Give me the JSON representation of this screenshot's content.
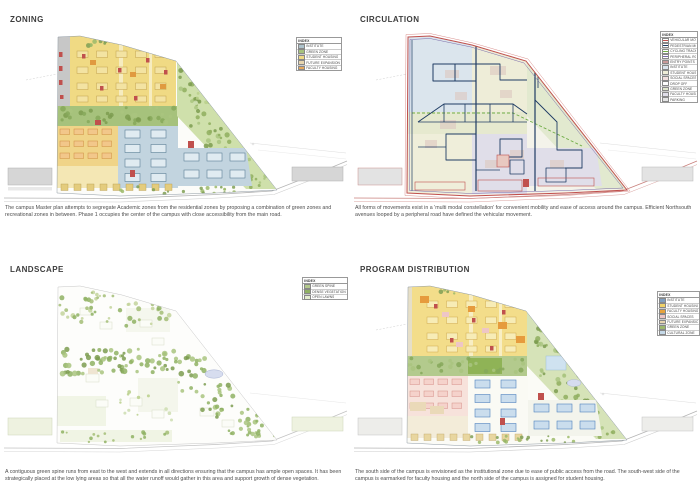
{
  "sheet": {
    "background": "#ffffff"
  },
  "colors": {
    "accent_red": "#c0504d",
    "navy": "#1f3c64",
    "peripheral_purple": "#7a6aa8",
    "green_dashed": "#70ad47"
  },
  "panels": [
    {
      "id": "zoning",
      "title": "ZONING",
      "caption": "The campus Master plan attempts to segregate Academic zones from the residential zones by proposing a combination of green zones and recreational zones in between. Phase 1 occupies the center of the campus with close accessibility from the main road.",
      "legend_title": "INDEX",
      "legend": [
        {
          "label": "INSTITUTE",
          "color": "#aec3cc"
        },
        {
          "label": "GREEN ZONE",
          "color": "#a6c27c"
        },
        {
          "label": "STUDENT HOUSING",
          "color": "#f0da84"
        },
        {
          "label": "FUTURE EXPANSION",
          "color": "#e7d5ae"
        },
        {
          "label": "FACULTY HOUSING",
          "color": "#e8a95c"
        }
      ]
    },
    {
      "id": "circulation",
      "title": "CIRCULATION",
      "caption": "All forms of movements exist in a 'multi modal constellation' for convenient mobility and ease of access around the campus. Efficient Northsouth avenues looped by a peripheral road have defined the vehicular movement.",
      "legend_title": "INDEX",
      "legend": [
        {
          "label": "VEHICULAR MOVEMENT",
          "color": "#c0504d",
          "type": "line"
        },
        {
          "label": "PEDESTRIAN MOVEMENT",
          "color": "#1f3c64",
          "type": "line"
        },
        {
          "label": "CYCLING TRACK",
          "color": "#70ad47",
          "type": "line"
        },
        {
          "label": "PERIPHERAL ROAD",
          "color": "#7a6aa8",
          "type": "line"
        },
        {
          "label": "ENTRY POINTS",
          "color": "#943634",
          "type": "line"
        },
        {
          "label": "INSTITUTE",
          "color": "#dbe5ed"
        },
        {
          "label": "STUDENT HOUSING",
          "color": "#eeedd8"
        },
        {
          "label": "SOCIAL SPACES",
          "color": "#f0dede"
        },
        {
          "label": "DROP OFF",
          "color": "#ffffff"
        },
        {
          "label": "GREEN ZONE",
          "color": "#e2e9cf"
        },
        {
          "label": "FACULTY HOUSING",
          "color": "#e0dee9"
        },
        {
          "label": "PARKING",
          "color": "#e4e4e4"
        }
      ]
    },
    {
      "id": "landscape",
      "title": "LANDSCAPE",
      "caption": "A contiguous green spine runs from east to the west and extends in all directions ensuring that the campus has ample open spaces. It has been strategically placed at the low lying areas so that all the water runoff would gather in this area and support growth of dense vegetation.",
      "legend_title": "INDEX",
      "legend": [
        {
          "label": "GREEN SPINE",
          "color": "#b4ca8c"
        },
        {
          "label": "DENSE VEGETATION",
          "color": "#8fb163"
        },
        {
          "label": "OPEN LAWNS",
          "color": "#e4edcf"
        }
      ]
    },
    {
      "id": "program",
      "title": "PROGRAM DISTRIBUTION",
      "caption": "The south side of the campus is envisioned as the institutional zone due to ease of public access from the road. The south-west side of the campus is earmarked for faculty housing and the north side of the campus is assigned for student housing.",
      "legend_title": "INDEX",
      "legend": [
        {
          "label": "INSTITUTE",
          "color": "#7f9fc0"
        },
        {
          "label": "STUDENT HOUSING",
          "color": "#f0d269"
        },
        {
          "label": "FACULTY HOUSING",
          "color": "#e8a33d"
        },
        {
          "label": "SOCIAL SPACES",
          "color": "#eec6c6"
        },
        {
          "label": "FUTURE EXPANSION",
          "color": "#e7d5ae"
        },
        {
          "label": "GREEN ZONE",
          "color": "#9cb86b"
        },
        {
          "label": "CULTURAL ZONE",
          "color": "#c5d9e8"
        }
      ]
    }
  ]
}
